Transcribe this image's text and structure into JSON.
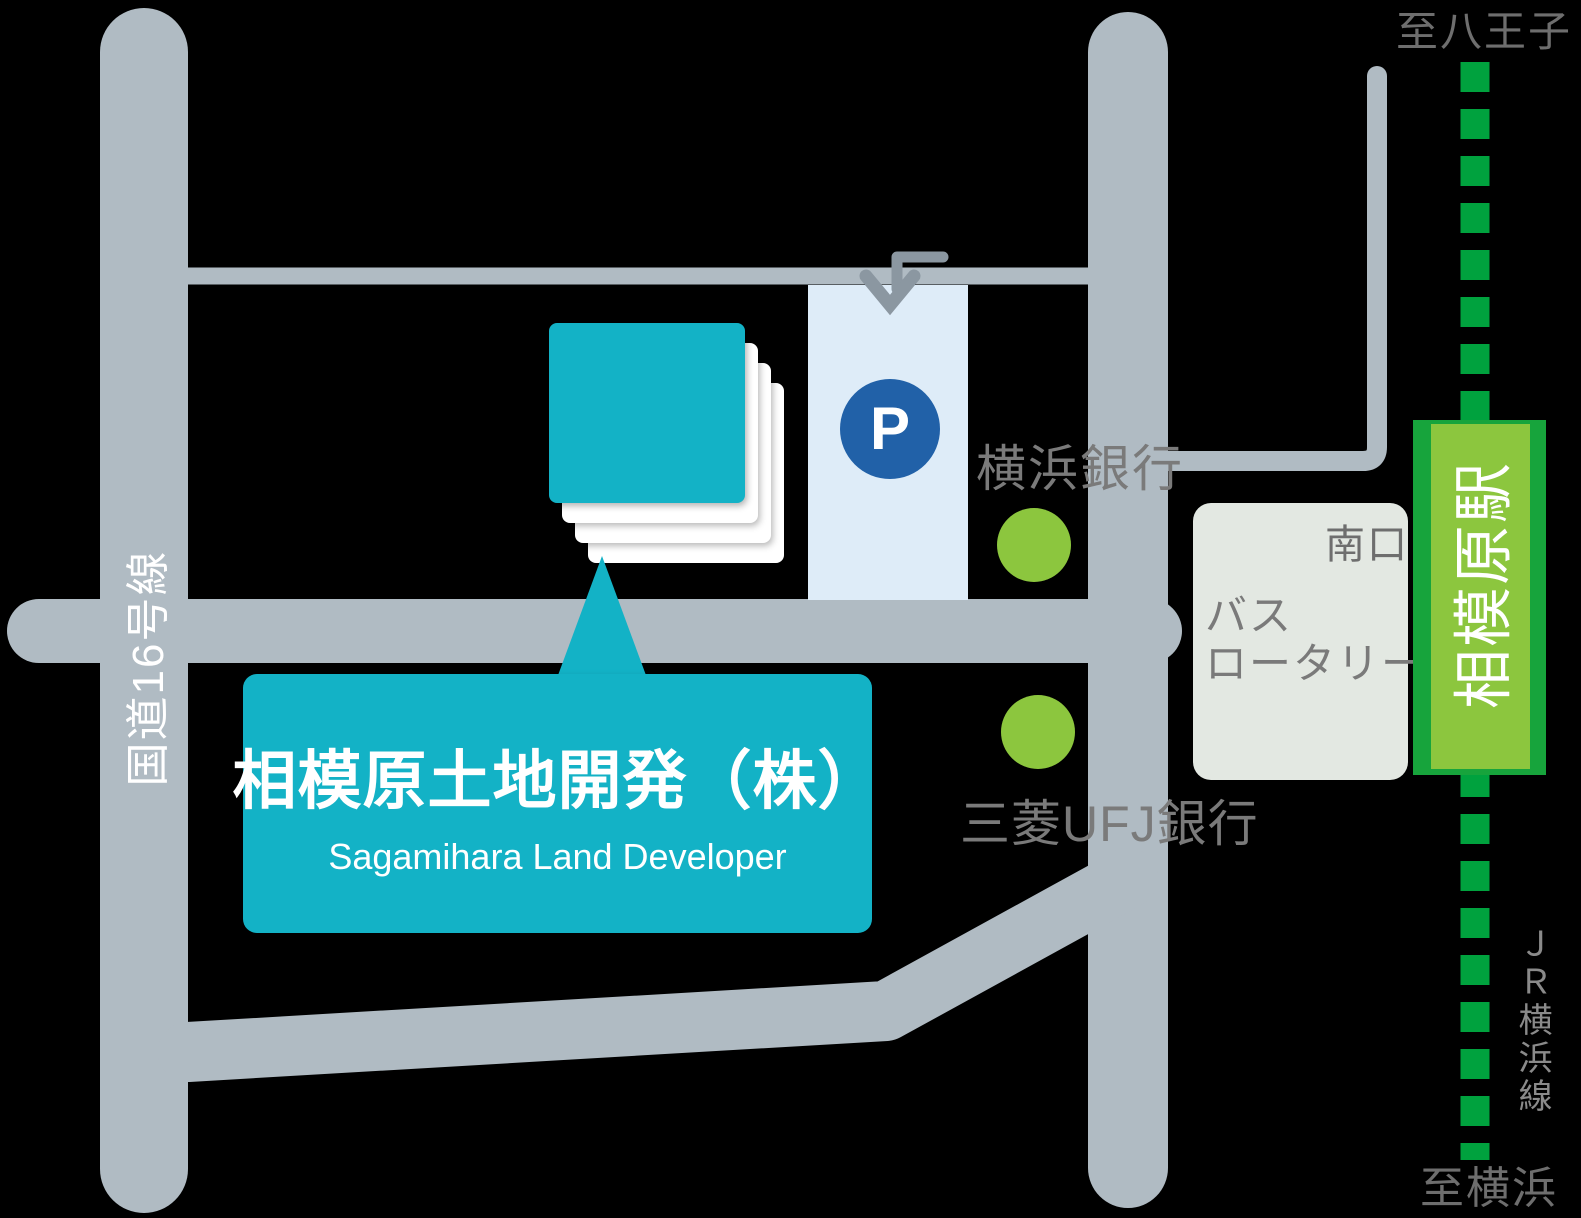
{
  "map": {
    "company": {
      "name": "相模原土地開発（株）",
      "name_en": "Sagamihara Land Developer"
    },
    "parking": {
      "symbol": "P"
    },
    "banks": [
      {
        "name": "横浜銀行"
      },
      {
        "name": "三菱UFJ銀行"
      }
    ],
    "bus_rotary": {
      "line1": "バス",
      "line2": "ロータリー"
    },
    "station": {
      "name": "相模原駅",
      "exit": "南口"
    },
    "railway": {
      "line_name": "ＪＲ横浜線",
      "direction_north": "至八王子",
      "direction_south": "至横浜"
    },
    "roads": {
      "route16": "国道16号線"
    },
    "colors": {
      "background": "#000000",
      "road": "#b0bbc3",
      "arrow": "#8b97a1",
      "parking_area": "#deecf8",
      "parking_blue": "#2161a8",
      "company_teal": "#13b2c6",
      "bank_dot_green": "#8cc63e",
      "station_frame_green": "#17a43c",
      "station_fill_green": "#8cc63e",
      "rail_dash_green": "#00a23e",
      "bus_rotary_box": "#e3e8e2",
      "label_gray": "#7a7a7a"
    }
  }
}
